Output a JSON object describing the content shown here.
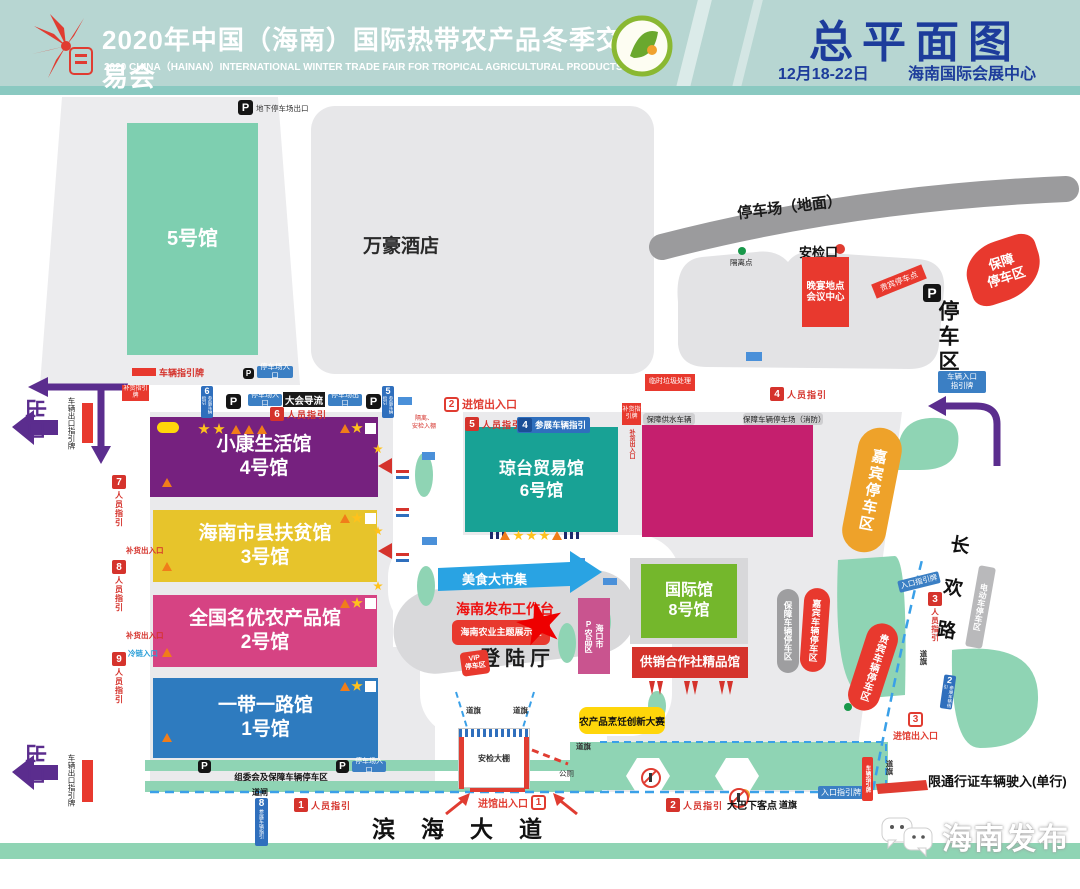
{
  "header": {
    "title_cn": "2020年中国（海南）国际热带农产品冬季交易会",
    "title_en": "2020 CHINA（HAINAN）INTERNATIONAL WINTER TRADE FAIR FOR TROPICAL AGRICULTURAL PRODUCTS",
    "plan_title": "总平面图",
    "date": "12月18-22日",
    "venue": "海南国际会展中心"
  },
  "halls": {
    "h5": "5号馆",
    "h4": {
      "l1": "小康生活馆",
      "l2": "4号馆"
    },
    "h3": {
      "l1": "海南市县扶贫馆",
      "l2": "3号馆"
    },
    "h2": {
      "l1": "全国名优农产品馆",
      "l2": "2号馆"
    },
    "h1": {
      "l1": "一带一路馆",
      "l2": "1号馆"
    },
    "h6": {
      "l1": "琼台贸易馆",
      "l2": "6号馆"
    },
    "h8": {
      "l1": "国际馆",
      "l2": "8号馆"
    },
    "gongxiao": "供销合作社精品馆"
  },
  "labels": {
    "p": "P",
    "underground_exit": "地下停车场出口",
    "vehicle_guide_sign": "车辆指引牌",
    "parking_entrance": "停车场入口",
    "parking_exit": "停车场出口",
    "marriott": "万豪酒店",
    "parking_ground": "停车场（地面）",
    "isolation_point": "隔离点",
    "security_gate": "安检口",
    "banquet": "晚宴地点\n会议中心",
    "vip_parking_spot": "贵宾停车点",
    "parking_zone": "停车区",
    "support_parking": "保障\n停车区",
    "trash": "临时垃圾处理",
    "vehicle_entrance_sign": "车辆入口\n指引牌",
    "exit": "出口",
    "vehicle_exit_sign": "车辆出口指引牌",
    "restock_gate": "补货出入口",
    "cold_chain": "冷链入口",
    "restock_sign": "补货指引牌",
    "conference_flow": "大会导流",
    "quarantine_note": "隔离、\n安检入棚",
    "support_water": "保障供水车辆",
    "support_parking_fire": "保障车辆停车场（消防）",
    "guest_parking": "嘉宾停车区",
    "support_vehicle_parking": "保障车辆停车区",
    "guest_vehicle_parking": "嘉宾车辆停车区",
    "vip_vehicle_parking": "贵宾车辆停车区",
    "entrance": "进馆出入口",
    "landing_hall": "登陆厅",
    "release_station": "海南发布工作台",
    "agri_theme_zone": "海南农业主题展示区",
    "haikou_zone": "海口市\nP农品区",
    "vip_zone": "VIP\n停车区",
    "food_market": "美食大市集",
    "cooking_contest": "农产品烹饪创新大赛",
    "security_shed": "安检大棚",
    "flag": "道旗",
    "barrier": "道闸",
    "committee_parking": "组委会及保障车辆停车区",
    "toilet": "公厕",
    "entrance_sign": "入口指引牌",
    "bus_drop": "大巴下客点",
    "binhai_road": "滨海大道",
    "changhuan_road": "长欢路",
    "ebike_parking": "电动车停车区",
    "restricted": "限通行证车辆驶入(单行)"
  },
  "guides": {
    "g1": {
      "num": "1",
      "label": "人员指引"
    },
    "g2": {
      "num": "2",
      "label": "人员指引"
    },
    "g3": {
      "num": "3",
      "label": "人员指引"
    },
    "g4": {
      "num": "4",
      "label": "人员指引"
    },
    "g5": {
      "num": "5",
      "label": "人员指引"
    },
    "g6": {
      "num": "6",
      "label": "人员指引"
    },
    "g7": {
      "num": "7",
      "label": "人员指引"
    },
    "g8": {
      "num": "8",
      "label": "人员指引"
    },
    "g9": {
      "num": "9",
      "label": "人员指引"
    },
    "v2": {
      "num": "2",
      "label": "参展车辆指引"
    },
    "v4": {
      "num": "4",
      "label": "参展车辆指引"
    },
    "v5": {
      "num": "5",
      "label": "参展车辆指引"
    },
    "v6": {
      "num": "6",
      "label": "参展车辆指引"
    },
    "v8": {
      "num": "8",
      "label": "参展车辆指引"
    },
    "e1": {
      "num": "1"
    },
    "e2": {
      "num": "2"
    },
    "e3": {
      "num": "3"
    }
  },
  "watermark": "海南发布"
}
